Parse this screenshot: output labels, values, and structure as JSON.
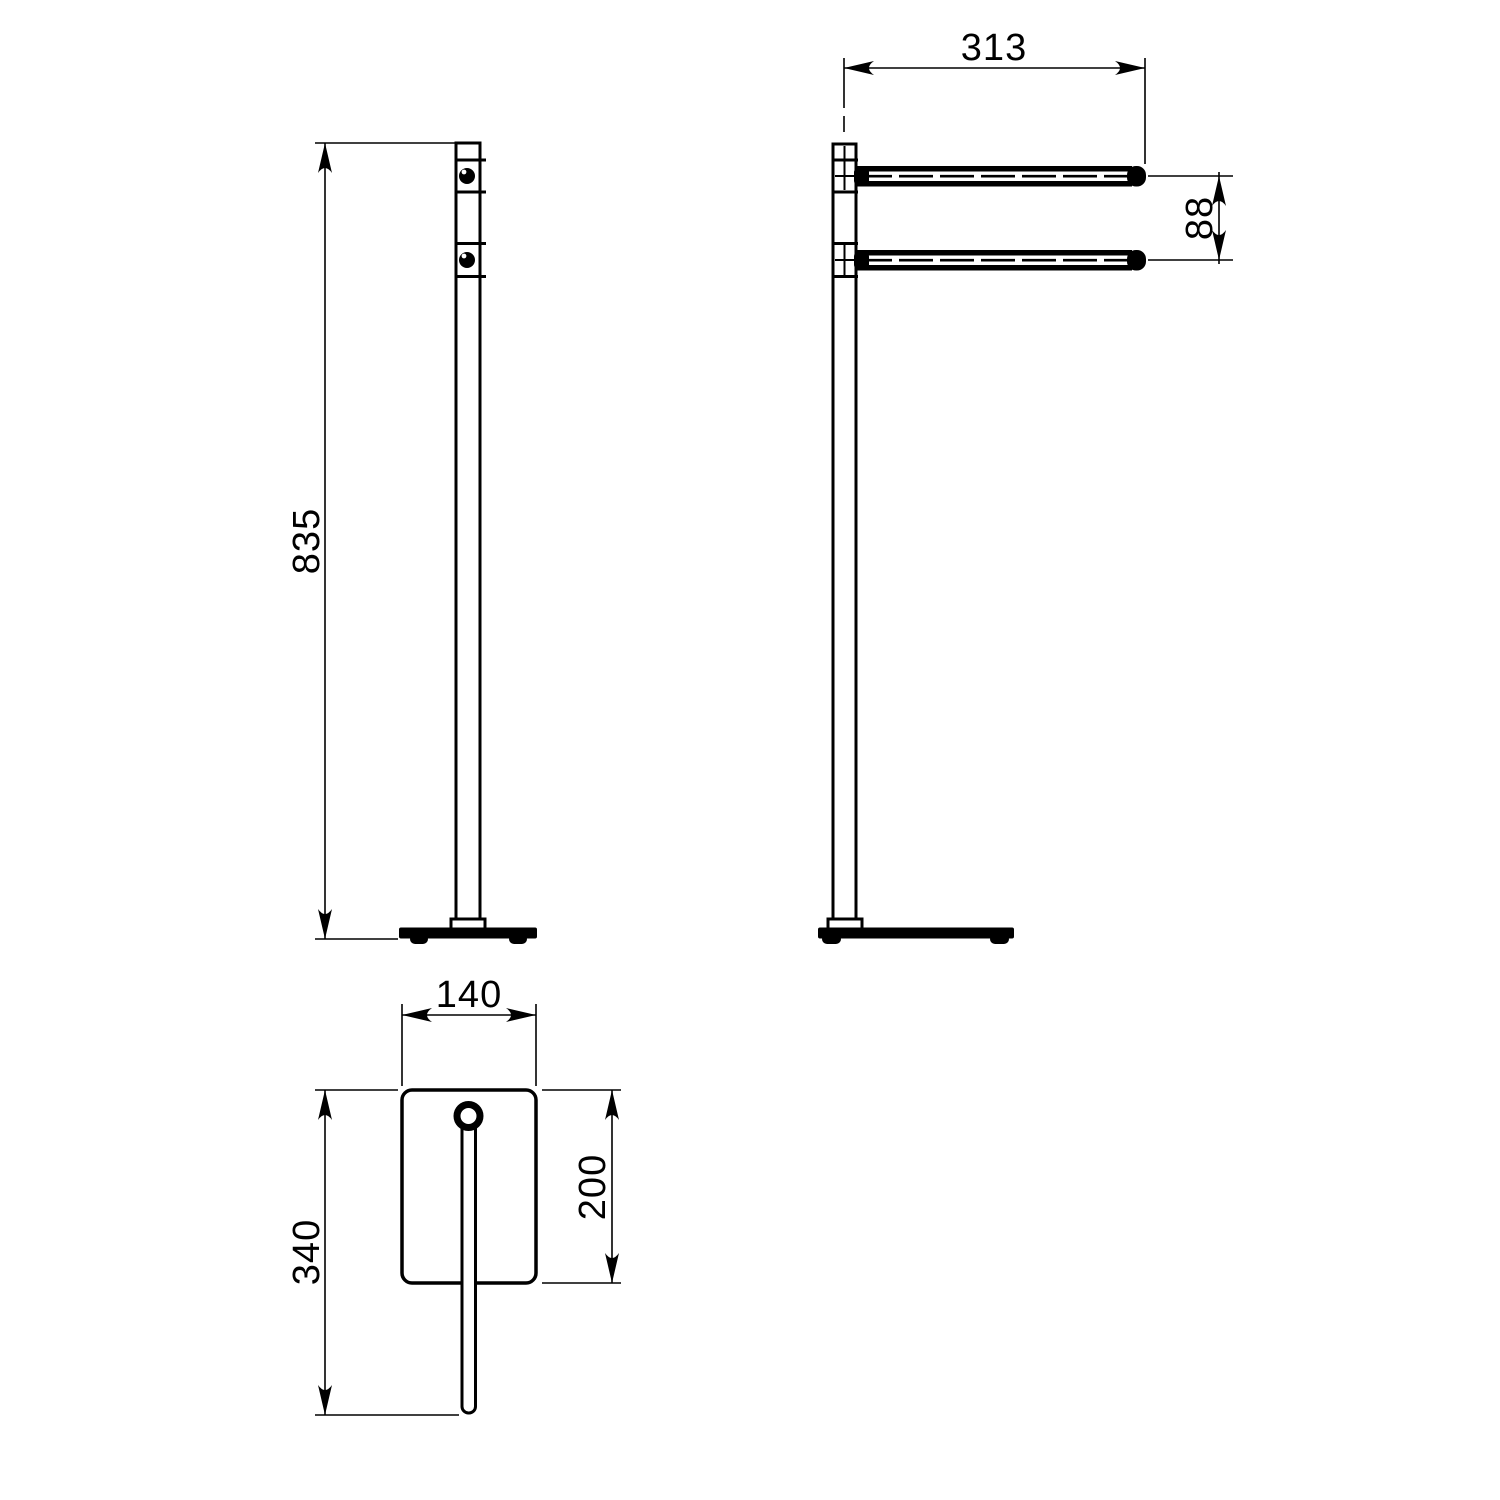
{
  "drawing": {
    "background": "#ffffff",
    "line_color": "#000000",
    "dimensions": {
      "stand_height": "835",
      "rail_length": "313",
      "rail_spacing": "88",
      "base_width": "140",
      "overall_depth": "340",
      "base_plate_depth": "200"
    }
  }
}
